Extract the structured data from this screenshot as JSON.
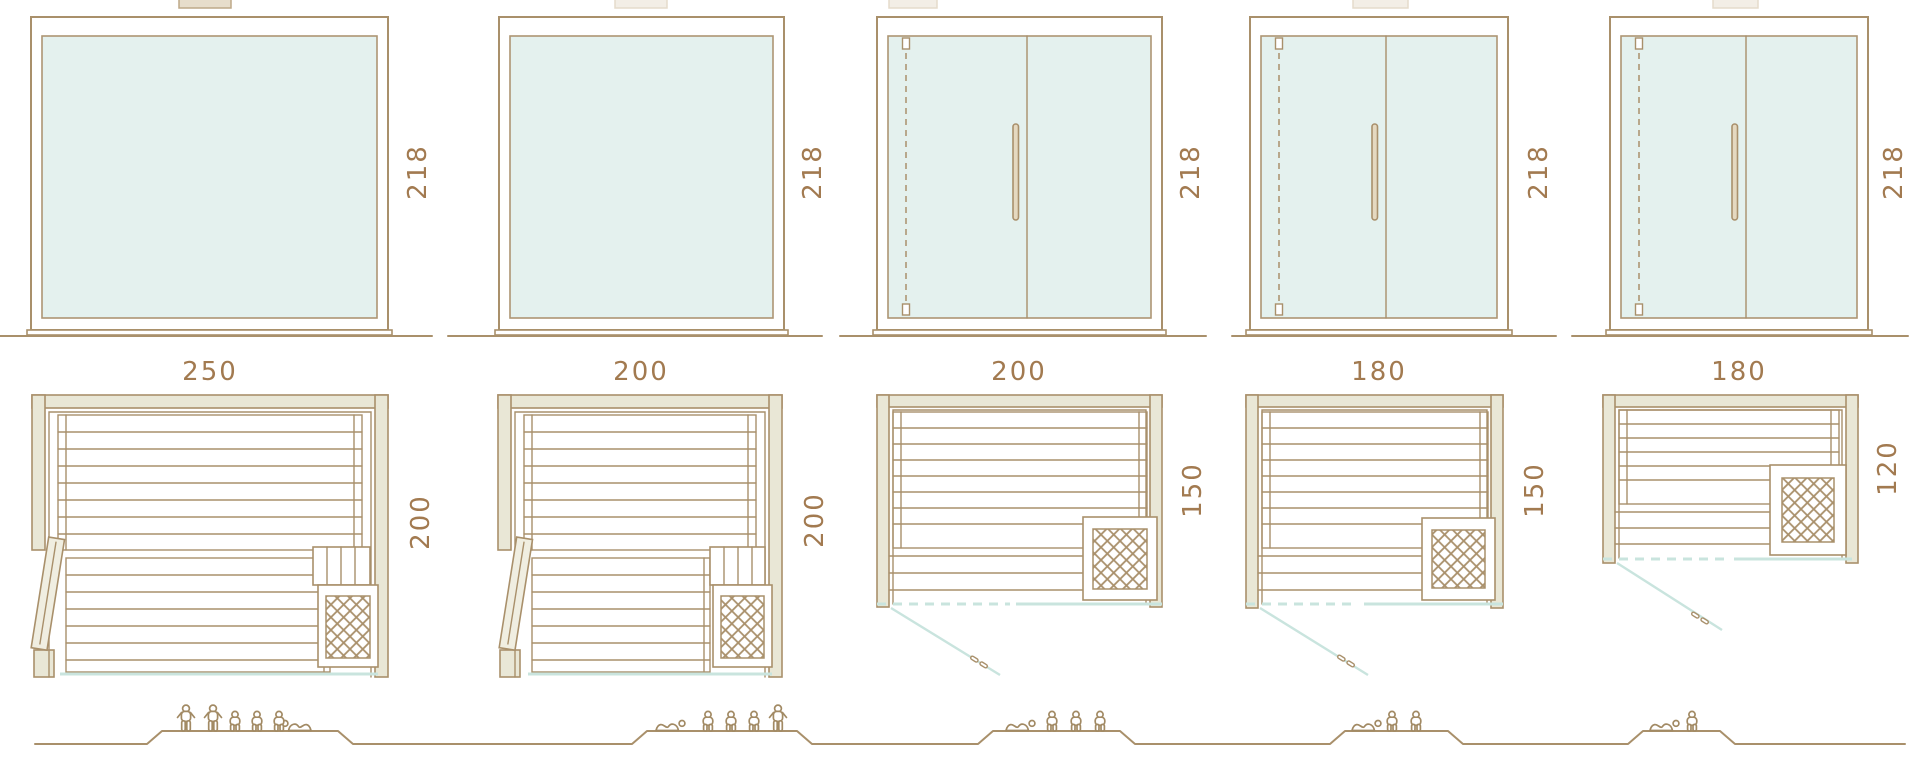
{
  "colors": {
    "outline": "#a9906b",
    "dimension_text": "#a27a50",
    "glass_fill": "#e4f1ee",
    "glass_front_line": "#c9e4de",
    "wall_fill": "#e9e7d6",
    "background": "#ffffff"
  },
  "units": [
    {
      "front": {
        "width_label": "250",
        "height_label": "218"
      },
      "plan": {
        "depth_label": "200"
      },
      "capacity": {
        "standing": 2,
        "seated": 3,
        "lying": 1
      }
    },
    {
      "front": {
        "width_label": "200",
        "height_label": "218"
      },
      "plan": {
        "depth_label": "200"
      },
      "capacity": {
        "standing": 1,
        "seated": 3,
        "lying": 1
      }
    },
    {
      "front": {
        "width_label": "200",
        "height_label": "218"
      },
      "plan": {
        "depth_label": "150"
      },
      "capacity": {
        "standing": 0,
        "seated": 3,
        "lying": 1
      }
    },
    {
      "front": {
        "width_label": "180",
        "height_label": "218"
      },
      "plan": {
        "depth_label": "150"
      },
      "capacity": {
        "standing": 0,
        "seated": 2,
        "lying": 1
      }
    },
    {
      "front": {
        "width_label": "180",
        "height_label": "218"
      },
      "plan": {
        "depth_label": "120"
      },
      "capacity": {
        "standing": 0,
        "seated": 1,
        "lying": 1
      }
    }
  ]
}
